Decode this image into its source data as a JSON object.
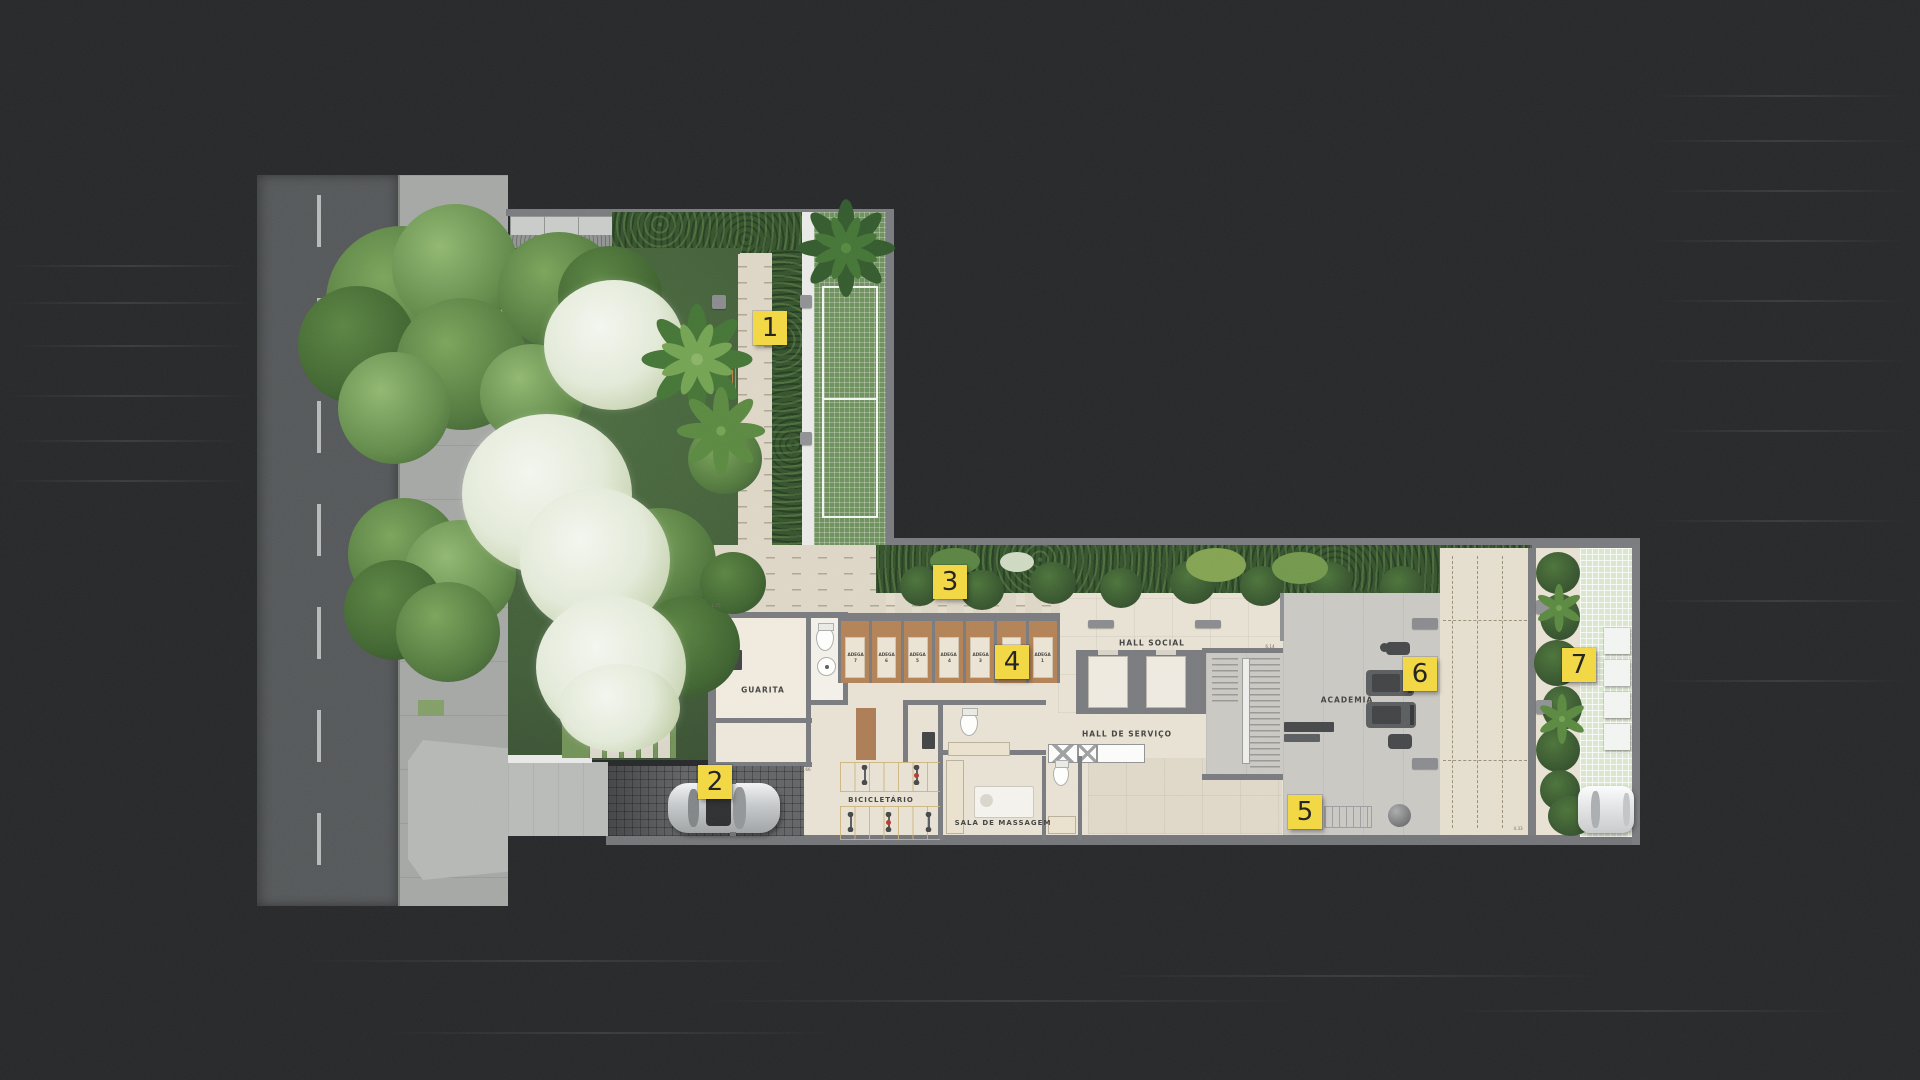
{
  "markers": [
    "1",
    "2",
    "3",
    "4",
    "5",
    "6",
    "7"
  ],
  "rooms": {
    "guarita": "GUARITA",
    "hall_social": "HALL SOCIAL",
    "hall_servico": "HALL DE SERVIÇO",
    "academia": "ACADEMIA",
    "bicicletario": "BICICLETÁRIO",
    "sala_massagem": "SALA DE MASSAGEM"
  },
  "adegas": {
    "prefix": "ADEGA",
    "units": [
      "7",
      "6",
      "5",
      "4",
      "3",
      "2",
      "1"
    ]
  },
  "dimensions": {
    "d1": "2.75",
    "d2": "5.66",
    "d3": "4.33",
    "d4": "6.14"
  },
  "colors": {
    "marker_yellow": "#f2d63b",
    "asphalt": "#1e2022",
    "road": "#4f5254",
    "sidewalk": "#a2a4a2",
    "floor": "#e7e0d2",
    "hedge": "#2e4c26",
    "tennis_court": "#698c58",
    "wood": "#b07e50",
    "wall": "#74767a"
  }
}
